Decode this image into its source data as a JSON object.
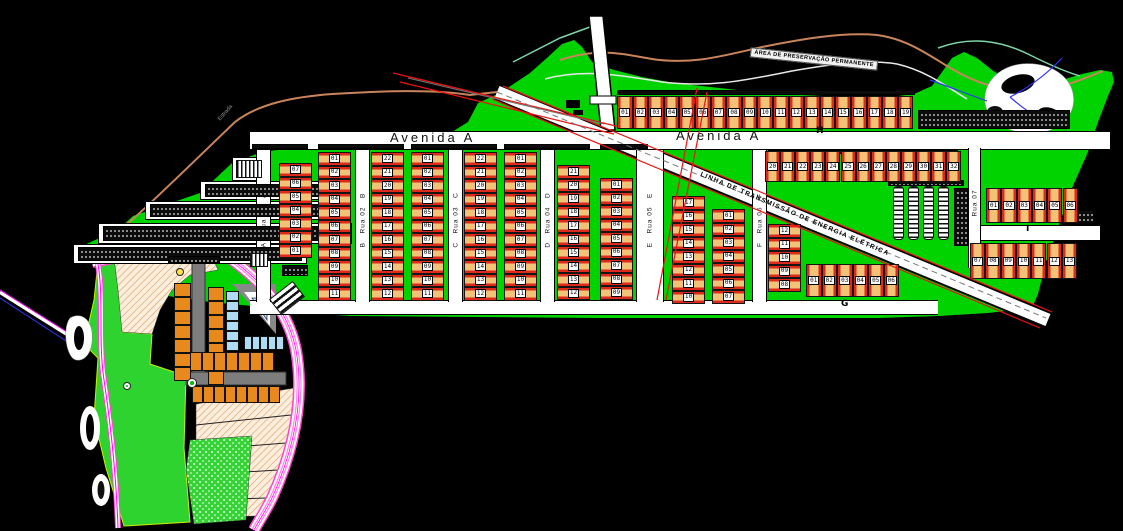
{
  "scene": {
    "width": 1123,
    "height": 531,
    "background": "#000000"
  },
  "palette": {
    "land_green": "#00d300",
    "lot_fill": "#f2c377",
    "lot_border_red": "#dd2a1a",
    "street_white": "#ffffff",
    "sub_orange": "#e8891d",
    "sub_blue": "#aedcf2",
    "road_pink": "#ff54d8",
    "road_magenta": "#ff00ff",
    "street_gray": "#7d7d7d",
    "river_tan": "#c8845a",
    "river_teal": "#7fd4a8",
    "stream_blue": "#3333ff",
    "line_red": "#ee1111",
    "hatch_tan": "#e09a5f"
  },
  "labels": {
    "avenida": "Avenida A",
    "preservation": "ÁREA DE PRESERVAÇÃO PERMANENTE",
    "transmission": "LINHA DE TRANSMISSÃO DE ENERGIA ELÉTRICA",
    "estrada": "Estrada"
  },
  "streets": {
    "vertical": [
      {
        "name": "Rua 01",
        "letter": "A",
        "x": 256
      },
      {
        "name": "Rua 02",
        "letter": "B",
        "x": 355
      },
      {
        "name": "Rua 03",
        "letter": "C",
        "x": 448
      },
      {
        "name": "Rua 04",
        "letter": "D",
        "x": 540
      },
      {
        "name": "Rua 05",
        "letter": "E",
        "x": 636,
        "w": 28
      },
      {
        "name": "Rua 06",
        "letter": "F",
        "x": 752
      },
      {
        "name": "Rua 07",
        "letter": "",
        "x": 968,
        "y1": 148,
        "y2": 268,
        "w": 13
      }
    ],
    "avenida": {
      "x": 250,
      "y": 131,
      "w": 860,
      "h": 19
    },
    "bottom": {
      "x": 250,
      "y": 300,
      "w": 688,
      "h": 15
    },
    "cross": {
      "x": 970,
      "y": 225,
      "w": 130,
      "h": 16
    }
  },
  "letters": [
    {
      "t": "H",
      "x": 816,
      "y": 126
    },
    {
      "t": "G",
      "x": 841,
      "y": 299
    },
    {
      "t": "I",
      "x": 1026,
      "y": 224
    }
  ],
  "blocks": {
    "lot_h": 13.5,
    "columns": [
      {
        "x": 279,
        "y": 163,
        "lots": [
          "07",
          "06",
          "05",
          "04",
          "03",
          "02",
          "01"
        ]
      },
      {
        "x": 318,
        "y": 152,
        "lots": [
          "01",
          "02",
          "03",
          "04",
          "05",
          "06",
          "07",
          "08",
          "09",
          "10",
          "11"
        ]
      },
      {
        "x": 371,
        "y": 152,
        "lots": [
          "22",
          "21",
          "20",
          "19",
          "18",
          "17",
          "16",
          "15",
          "14",
          "13",
          "12"
        ]
      },
      {
        "x": 411,
        "y": 152,
        "lots": [
          "01",
          "02",
          "03",
          "04",
          "05",
          "06",
          "07",
          "08",
          "09",
          "10",
          "11"
        ]
      },
      {
        "x": 464,
        "y": 152,
        "lots": [
          "22",
          "21",
          "20",
          "19",
          "18",
          "17",
          "16",
          "15",
          "14",
          "13",
          "12"
        ]
      },
      {
        "x": 504,
        "y": 152,
        "lots": [
          "01",
          "02",
          "03",
          "04",
          "05",
          "06",
          "07",
          "08",
          "09",
          "10",
          "11"
        ]
      },
      {
        "x": 557,
        "y": 165,
        "lots": [
          "21",
          "20",
          "19",
          "18",
          "17",
          "16",
          "15",
          "14",
          "13",
          "12"
        ]
      },
      {
        "x": 600,
        "y": 178,
        "lots": [
          "01",
          "02",
          "03",
          "04",
          "05",
          "06",
          "07",
          "08",
          "09"
        ]
      },
      {
        "x": 672,
        "y": 196,
        "lots": [
          "17",
          "16",
          "15",
          "14",
          "13",
          "12",
          "11",
          "10"
        ]
      },
      {
        "x": 712,
        "y": 209,
        "lots": [
          "01",
          "02",
          "03",
          "04",
          "05",
          "06",
          "07"
        ]
      },
      {
        "x": 768,
        "y": 224,
        "lots": [
          "12",
          "11",
          "10",
          "09",
          "08"
        ]
      }
    ],
    "rows": [
      {
        "x": 617,
        "y": 96,
        "w": 15.6,
        "h": 33,
        "lots": [
          "01",
          "02",
          "03",
          "04",
          "05",
          "06",
          "07",
          "08",
          "09",
          "10",
          "11",
          "12",
          "13",
          "14",
          "15",
          "16",
          "17",
          "18",
          "19"
        ]
      },
      {
        "x": 765,
        "y": 151,
        "w": 15.1,
        "h": 31,
        "lots": [
          "20",
          "21",
          "22",
          "23",
          "24",
          "25",
          "26",
          "27",
          "28",
          "29",
          "30",
          "31",
          "32"
        ]
      },
      {
        "x": 806,
        "y": 264,
        "w": 15.5,
        "h": 33,
        "lots": [
          "01",
          "02",
          "03",
          "04",
          "05",
          "06"
        ]
      },
      {
        "x": 986,
        "y": 188,
        "w": 15.3,
        "h": 35,
        "lots": [
          "01",
          "02",
          "03",
          "04",
          "05",
          "06"
        ]
      },
      {
        "x": 970,
        "y": 243,
        "w": 15.3,
        "h": 36,
        "lots": [
          "07",
          "08",
          "09",
          "10",
          "11",
          "12",
          "13"
        ]
      }
    ]
  },
  "decor": {
    "white_strips": [
      [
        200,
        181,
        150,
        19
      ],
      [
        145,
        201,
        193,
        19
      ],
      [
        98,
        223,
        254,
        21
      ],
      [
        73,
        244,
        234,
        20
      ],
      [
        232,
        157,
        32,
        24
      ]
    ],
    "dotted_bars": [
      [
        205,
        184,
        128,
        13
      ],
      [
        150,
        204,
        183,
        13
      ],
      [
        103,
        226,
        244,
        15
      ],
      [
        78,
        247,
        224,
        14
      ],
      [
        918,
        110,
        152,
        19
      ],
      [
        617,
        90,
        298,
        5
      ],
      [
        768,
        150,
        190,
        4
      ],
      [
        888,
        180,
        76,
        6
      ],
      [
        954,
        188,
        14,
        58
      ],
      [
        1076,
        210,
        18,
        13
      ],
      [
        252,
        144,
        56,
        5
      ],
      [
        318,
        144,
        86,
        5
      ],
      [
        411,
        144,
        86,
        5
      ],
      [
        504,
        144,
        86,
        5
      ],
      [
        600,
        144,
        48,
        5
      ],
      [
        168,
        256,
        52,
        7
      ],
      [
        282,
        265,
        26,
        11
      ]
    ],
    "stairs": [
      [
        893,
        186,
        11,
        54
      ],
      [
        908,
        186,
        11,
        54
      ],
      [
        923,
        186,
        11,
        54
      ],
      [
        938,
        186,
        11,
        54
      ]
    ],
    "striped_blocks": [
      [
        236,
        160,
        26,
        18
      ],
      [
        250,
        253,
        18,
        14
      ]
    ],
    "zebra": {
      "x": 272,
      "y": 288,
      "w": 30,
      "h": 20,
      "rot": -38
    }
  },
  "subdivision": {
    "columns": [
      {
        "x": 174,
        "y": 283,
        "w": 17,
        "h": 14,
        "n": 7,
        "color": "orange"
      },
      {
        "x": 208,
        "y": 287,
        "w": 16,
        "h": 14,
        "n": 7,
        "color": "orange"
      },
      {
        "x": 226,
        "y": 291,
        "w": 13,
        "h": 10,
        "n": 6,
        "color": "blue"
      }
    ],
    "rows": [
      {
        "x": 190,
        "y": 352,
        "w": 12,
        "h": 19,
        "n": 7,
        "color": "orange"
      },
      {
        "x": 192,
        "y": 386,
        "w": 11,
        "h": 17,
        "n": 8,
        "color": "orange"
      },
      {
        "x": 244,
        "y": 336,
        "w": 8,
        "h": 14,
        "n": 5,
        "color": "blue"
      }
    ],
    "markers": [
      {
        "x": 180,
        "y": 272,
        "r": 4,
        "fill": "#ffe34d",
        "inner": ""
      },
      {
        "x": 192,
        "y": 383,
        "r": 5,
        "fill": "#ffffff",
        "inner": "#00c000"
      },
      {
        "x": 127,
        "y": 386,
        "r": 4,
        "fill": "#ffffff",
        "inner": "#00c000"
      }
    ]
  }
}
